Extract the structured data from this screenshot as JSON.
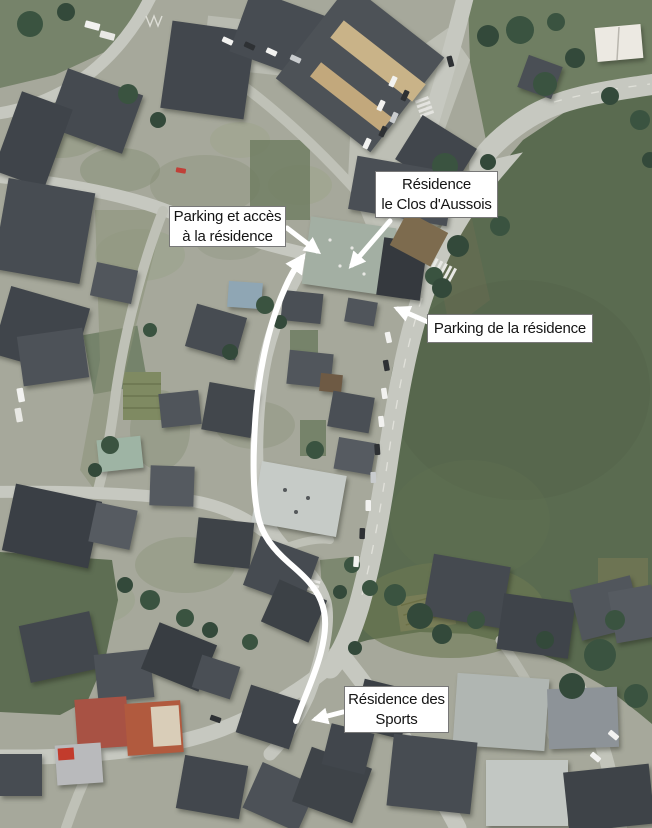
{
  "annotations": {
    "parking_access": {
      "line1": "Parking et accès",
      "line2": "à la résidence"
    },
    "residence_clos": {
      "line1": "Résidence",
      "line2": "le Clos d'Aussois"
    },
    "parking_residence": {
      "line1": "Parking de la résidence"
    },
    "residence_sports": {
      "line1": "Résidence des",
      "line2": "Sports"
    }
  },
  "markers": {
    "route_line": "white-route-path-along-street",
    "route_arrowhead": "white-arrowhead-up-right",
    "parking_access_arrow": "white-arrow-down-right",
    "residence_clos_arrow": "white-arrow-down-left",
    "parking_residence_arrow": "white-arrow-up-left",
    "residence_sports_arrow": "white-arrow-left"
  },
  "colors": {
    "annotation_background": "#ffffff",
    "annotation_text": "#141414",
    "annotation_border": "#787878",
    "route_and_arrows": "#ffffff",
    "field_green": "#5a6b50",
    "road_gray": "#c6c8c0",
    "roof_slate": "#474c52"
  }
}
